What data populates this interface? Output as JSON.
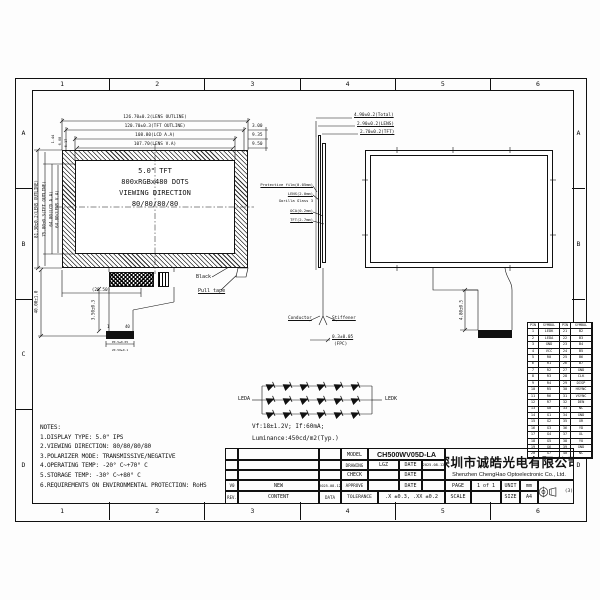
{
  "sheet": {
    "zones_h": [
      "1",
      "2",
      "3",
      "4",
      "5",
      "6"
    ],
    "zones_v": [
      "A",
      "B",
      "C",
      "D"
    ]
  },
  "front_view": {
    "display_text": [
      "5.0\" TFT",
      "800xRGBx480 DOTS",
      "VIEWING DIRECTION",
      "80/80/80/80"
    ],
    "dims_top": [
      "126.70±0.2(LENS OUTLINE)",
      "120.70±0.3(TFT OUTLINE)",
      "108.80(LCD A.A)",
      "107.70(LENS V.A)"
    ],
    "dims_right": [
      "3.00",
      "9.35",
      "9.50"
    ],
    "dims_left": [
      "81.30±0.2(LENS OUTLINE)",
      "75.80±0.3(TFT OUTLINE)",
      "64.80(LCD A.A)",
      "64.80(LENS V.A)"
    ],
    "dims_left_top": [
      "1.44",
      "6.08",
      "6.17"
    ],
    "dim_height_total": "40.00±1.0",
    "dim_connector_offset": "(28.50)",
    "dim_tail_length": "3.50±0.3",
    "label_black": "Black",
    "label_pull_tape": "Pull tape",
    "pin_first": "1",
    "pin_last": "40",
    "dim_fpc_pitch": "P0.5±0.05",
    "dim_fpc_width": "20.50±0.1"
  },
  "side_view": {
    "dims_top": [
      "4.90±0.2(Total)",
      "2.90±0.2(LENS)",
      "2.70±0.2(TFT)"
    ],
    "stack_labels": [
      "Protective film(0.05mm)",
      "LENS(2.0mm)",
      "Gorilla Glass 3",
      "OCA(0.2mm)",
      "TFT(2.7mm)"
    ],
    "label_conductor": "Conductor",
    "label_stiffener": "Stiffener",
    "dim_fpc": "0.3±0.05",
    "fpc_caption": "(FPC)"
  },
  "back_view": {
    "dim_tail": "4.80±0.5"
  },
  "led_circuit": {
    "label_left": "LEDA",
    "label_right": "LEDK",
    "rows": 3,
    "cols": 6,
    "spec_line1": "Vf:18±1.2V;  If:60mA;",
    "spec_line2": "Luminance:450cd/m2(Typ.)"
  },
  "pin_table": {
    "headers": [
      "PIN",
      "SYMBOL",
      "PIN",
      "SYMBOL"
    ],
    "rows": [
      [
        "1",
        "LEDK",
        "21",
        "B2"
      ],
      [
        "2",
        "LEDA",
        "22",
        "B3"
      ],
      [
        "3",
        "GND",
        "23",
        "B4"
      ],
      [
        "4",
        "VCC",
        "24",
        "B5"
      ],
      [
        "5",
        "R0",
        "25",
        "B6"
      ],
      [
        "6",
        "R1",
        "26",
        "B7"
      ],
      [
        "7",
        "R2",
        "27",
        "GND"
      ],
      [
        "8",
        "R3",
        "28",
        "CLK"
      ],
      [
        "9",
        "R4",
        "29",
        "DISP"
      ],
      [
        "10",
        "R5",
        "30",
        "HSYNC"
      ],
      [
        "11",
        "R6",
        "31",
        "VSYNC"
      ],
      [
        "12",
        "R7",
        "32",
        "DEN"
      ],
      [
        "13",
        "G0",
        "33",
        "NC"
      ],
      [
        "14",
        "G1",
        "34",
        "GND"
      ],
      [
        "15",
        "G2",
        "35",
        "XR"
      ],
      [
        "16",
        "G3",
        "36",
        "YD"
      ],
      [
        "17",
        "G4",
        "37",
        "XL"
      ],
      [
        "18",
        "G5",
        "38",
        "YU"
      ],
      [
        "19",
        "G6",
        "39",
        "GND"
      ],
      [
        "20",
        "G7",
        "40",
        "NC"
      ]
    ]
  },
  "notes": {
    "title": "NOTES:",
    "items": [
      "1.DISPLAY TYPE:  5.0\" IPS",
      "2.VIEWING DIRECTION:  80/80/80/80",
      "3.POLARIZER MODE: TRANSMISSIVE/NEGATIVE",
      "4.OPERATING TEMP: -20° C~+70° C",
      "5.STORAGE TEMP: -30° C~+80° C",
      "6.REQUIREMENTS ON ENVIRONMENTAL PROTECTION: RoHS"
    ]
  },
  "title_block": {
    "model_label": "MODEL",
    "model": "CH500WV05D-LA",
    "drawing_label": "DRAWING",
    "drawing": "LGZ",
    "date_label": "DATE",
    "drawing_date": "2025.08.12",
    "check_label": "CHECK",
    "approve_label": "APPROVE",
    "tolerance_label": "TOLERANCE",
    "tolerance": ".X ±0.3, .XX ±0.2",
    "rev": "V0",
    "rev_content": "NEW",
    "rev_date": "2025.08.12",
    "rev_label": "REV.",
    "content_label": "CONTENT",
    "data_label": "DATA",
    "company_cn": "深圳市诚皓光电有限公司",
    "company_en": "Shenzhen ChengHao Optoelectronic Co., Ltd.",
    "page_label": "PAGE",
    "page": "1 of 1",
    "unit_label": "UNIT",
    "unit": "mm",
    "scale_label": "SCALE",
    "size_label": "SIZE",
    "size": "A4",
    "projection_note": "(3)"
  }
}
